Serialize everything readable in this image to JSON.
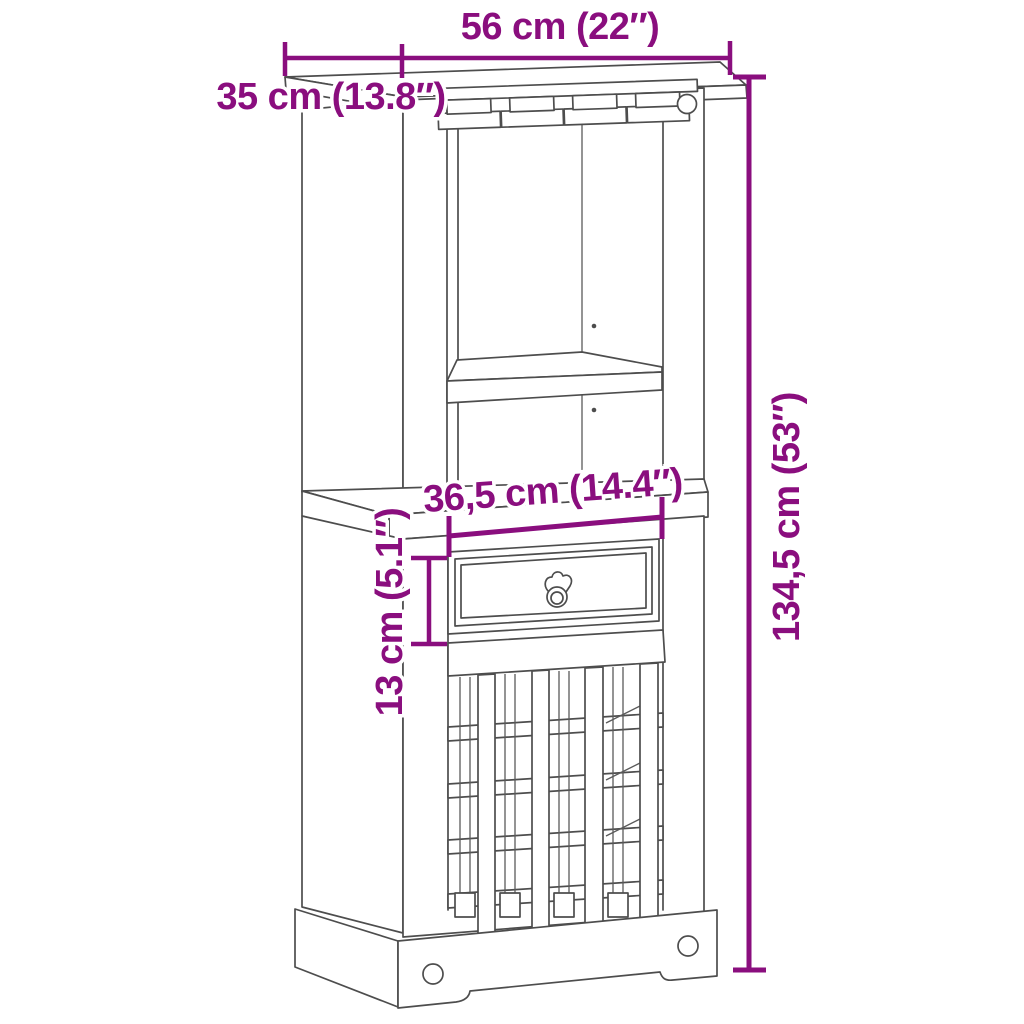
{
  "diagram": {
    "kind": "furniture dimension line drawing",
    "subject": "wine-bar-cabinet",
    "colors": {
      "dimension_accent": "#8A0E7E",
      "outline": "#4D4D4D",
      "background": "#FFFFFF"
    },
    "dimensions": {
      "width": {
        "label": "56 cm (22″)",
        "cm": "56",
        "inches": "22",
        "orientation": "horizontal"
      },
      "depth": {
        "label": "35 cm (13.8″)",
        "cm": "35",
        "inches": "13.8",
        "orientation": "horizontal"
      },
      "drawer_width": {
        "label": "36,5 cm (14.4″)",
        "cm": "36,5",
        "inches": "14.4",
        "orientation": "horizontal"
      },
      "drawer_height": {
        "label": "13 cm (5.1″)",
        "cm": "13",
        "inches": "5.1",
        "orientation": "vertical"
      },
      "height": {
        "label": "134,5 cm (53″)",
        "cm": "134,5",
        "inches": "53",
        "orientation": "vertical"
      }
    }
  }
}
